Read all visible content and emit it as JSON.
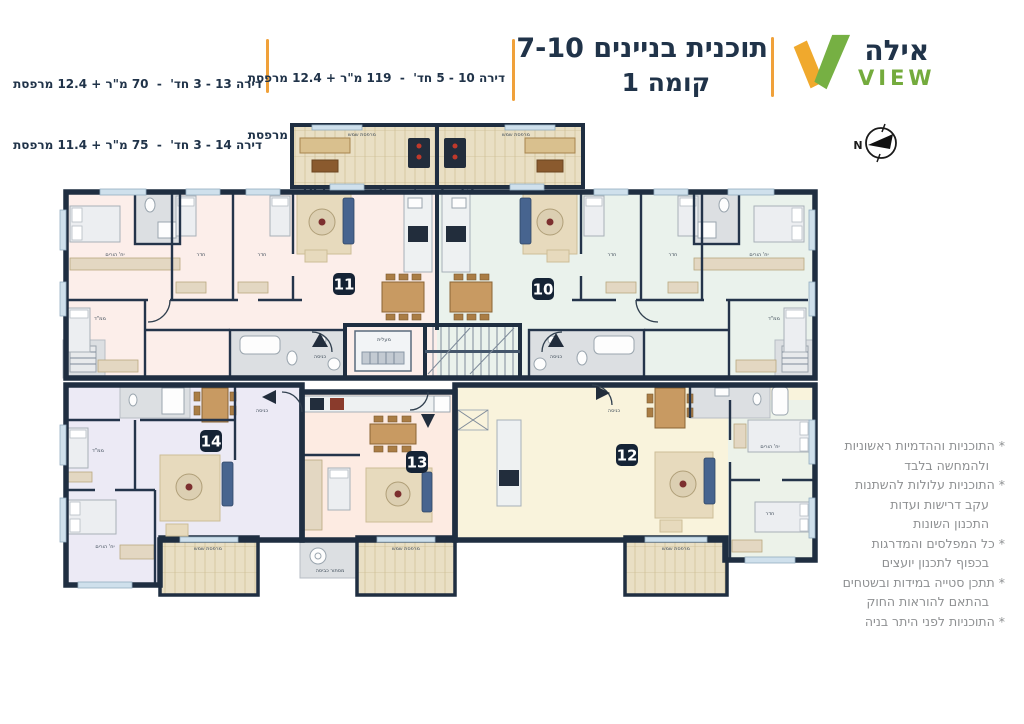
{
  "header": {
    "logo": {
      "name_hebrew": "אילה",
      "name_latin": "VIEW"
    },
    "title": {
      "line1": "תוכנית בניינים 7-10",
      "line2": "קומה 1"
    },
    "apartment_list_center": [
      "דירה 10 - 5 חד'  -  119 מ\"ר + 12.4 מרפסת",
      "דירה 11 - 5 חד'  -  119 מ\"ר + 12.4 מרפסת",
      "דירה 12 - 3 חד'  -  75 מ\"ר + 10.6 מרפסת"
    ],
    "apartment_list_left": [
      "דירה 13 - 3 חד'  -  70 מ\"ר + 12.4 מרפסת",
      "דירה 14 - 3 חד'  -  75 מ\"ר + 11.4 מרפסת"
    ]
  },
  "notes": [
    "* התוכניות וההדמיות ראשוניות",
    "ולהמחשה בלבד",
    "* התוכניות עלולות להשתנות",
    "עקב דרישות ועדות",
    "התכנון השונות",
    "* כל המפלסים והמדרגות",
    "בכפוף לתכנון יועצים",
    "* תתכן סטייה במידות ובשטחים",
    "בהתאם להוראות החוק",
    "* התוכניות לפני היתר בניה"
  ],
  "plan": {
    "apartments": [
      {
        "number": "10"
      },
      {
        "number": "11"
      },
      {
        "number": "12"
      },
      {
        "number": "13"
      },
      {
        "number": "14"
      }
    ],
    "compass": {
      "label": "N"
    },
    "room_labels": [
      {
        "x": 115,
        "y": 256,
        "text": "יח' הורים"
      },
      {
        "x": 201,
        "y": 256,
        "text": "חדר"
      },
      {
        "x": 262,
        "y": 256,
        "text": "חדר"
      },
      {
        "x": 100,
        "y": 320,
        "text": "ממ\"ד"
      },
      {
        "x": 759,
        "y": 256,
        "text": "יח' הורים"
      },
      {
        "x": 612,
        "y": 256,
        "text": "חדר"
      },
      {
        "x": 673,
        "y": 256,
        "text": "חדר"
      },
      {
        "x": 774,
        "y": 320,
        "text": "ממ\"ד"
      },
      {
        "x": 105,
        "y": 548,
        "text": "יח' הורים"
      },
      {
        "x": 98,
        "y": 452,
        "text": "ממ\"ד"
      },
      {
        "x": 770,
        "y": 448,
        "text": "יח' הורים"
      },
      {
        "x": 770,
        "y": 515,
        "text": "חדר"
      },
      {
        "x": 362,
        "y": 136,
        "text": "מרפסת שמש"
      },
      {
        "x": 516,
        "y": 136,
        "text": "מרפסת שמש"
      },
      {
        "x": 208,
        "y": 550,
        "text": "מרפסת שמש"
      },
      {
        "x": 406,
        "y": 550,
        "text": "מרפסת שמש"
      },
      {
        "x": 676,
        "y": 550,
        "text": "מרפסת שמש"
      },
      {
        "x": 330,
        "y": 572,
        "text": "מסתור כביסה"
      },
      {
        "x": 320,
        "y": 358,
        "text": "כניסה"
      },
      {
        "x": 556,
        "y": 358,
        "text": "כניסה"
      },
      {
        "x": 262,
        "y": 412,
        "text": "כניסה"
      },
      {
        "x": 614,
        "y": 412,
        "text": "כניסה"
      },
      {
        "x": 384,
        "y": 341,
        "text": "מעלית"
      }
    ]
  }
}
